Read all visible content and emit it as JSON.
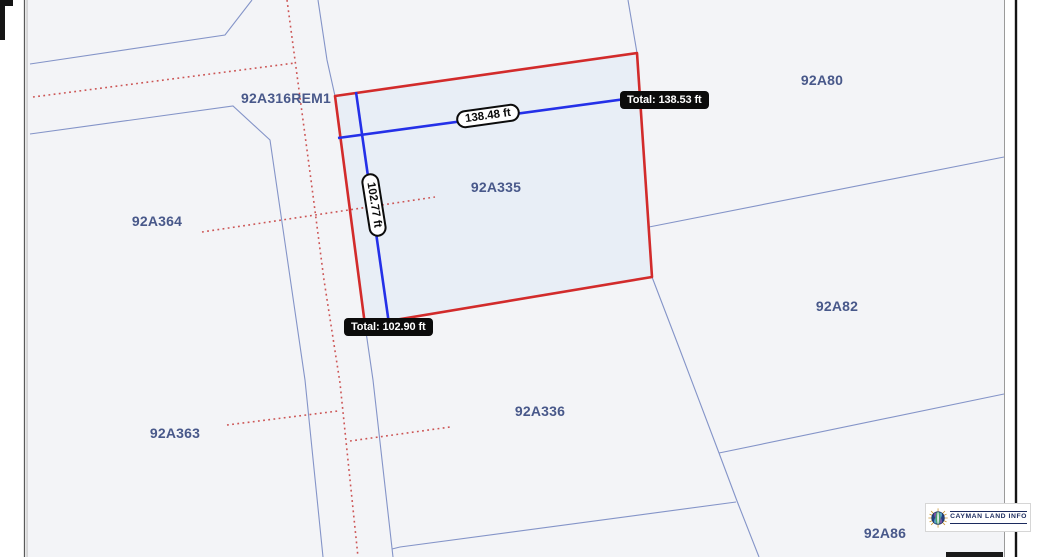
{
  "parcels": [
    {
      "id": "92A316REM1"
    },
    {
      "id": "92A364"
    },
    {
      "id": "92A363"
    },
    {
      "id": "92A335"
    },
    {
      "id": "92A336"
    },
    {
      "id": "92A80"
    },
    {
      "id": "92A82"
    },
    {
      "id": "92A86"
    }
  ],
  "selected_parcel": "92A335",
  "measurements": {
    "top_segment_length": "138.48 ft",
    "top_total": "Total: 138.53 ft",
    "left_segment_length": "102.77 ft",
    "left_total": "Total: 102.90 ft"
  },
  "branding": {
    "logo_text": "CAYMAN LAND INFO"
  },
  "colors": {
    "selection_outline": "#d22b2b",
    "selected_fill": "#e8eef6",
    "boundary_line": "#8494c8",
    "road_centerline_dotted": "#cc5555",
    "measure_line": "#2430e8",
    "parcel_label_text": "#48588a",
    "map_background": "#f3f4f7"
  }
}
